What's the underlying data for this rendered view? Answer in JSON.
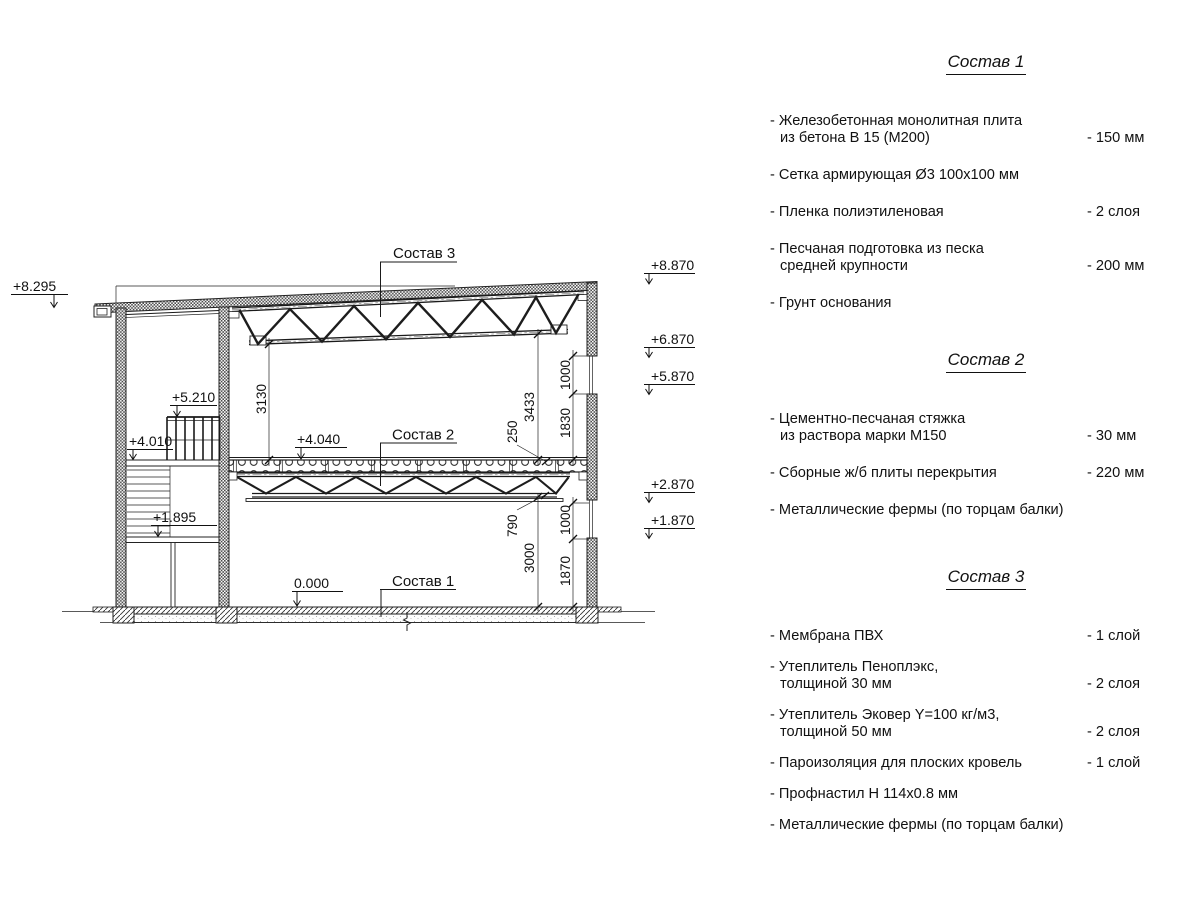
{
  "colors": {
    "line": "#1a1a1a",
    "background": "#ffffff"
  },
  "compositions": [
    {
      "title": "Состав 1",
      "items": [
        {
          "lines": [
            "- Железобетонная  монолитная плита",
            "из бетона В 15 (М200)"
          ],
          "value": "- 150 мм"
        },
        {
          "lines": [
            "- Сетка армирующая Ø3 100x100 мм"
          ],
          "value": ""
        },
        {
          "lines": [
            "- Пленка полиэтиленовая"
          ],
          "value": "-  2 слоя"
        },
        {
          "lines": [
            "- Песчаная подготовка из песка",
            "средней крупности"
          ],
          "value": "- 200 мм"
        },
        {
          "lines": [
            "- Грунт основания"
          ],
          "value": ""
        }
      ]
    },
    {
      "title": "Состав 2",
      "items": [
        {
          "lines": [
            "- Цементно-песчаная стяжка",
            "из раствора марки М150"
          ],
          "value": "- 30 мм"
        },
        {
          "lines": [
            "- Сборные ж/б плиты перекрытия"
          ],
          "value": "- 220 мм"
        },
        {
          "lines": [
            "- Металлические фермы (по торцам балки)"
          ],
          "value": ""
        }
      ]
    },
    {
      "title": "Состав 3",
      "items": [
        {
          "lines": [
            "- Мембрана ПВХ"
          ],
          "value": "- 1 слой"
        },
        {
          "lines": [
            "- Утеплитель Пеноплэкс,",
            "толщиной 30 мм"
          ],
          "value": "- 2 слоя"
        },
        {
          "lines": [
            "- Утеплитель Эковер Y=100 кг/м3,",
            "толщиной 50 мм"
          ],
          "value": "- 2 слоя"
        },
        {
          "lines": [
            "- Пароизоляция для плоских кровель"
          ],
          "value": "- 1 слой"
        },
        {
          "lines": [
            "- Профнастил Н 114x0.8 мм"
          ],
          "value": ""
        },
        {
          "lines": [
            "- Металлические фермы (по торцам балки)"
          ],
          "value": ""
        }
      ]
    }
  ],
  "drawing": {
    "callouts": {
      "c1": "Состав 1",
      "c2": "Состав 2",
      "c3": "Состав 3"
    },
    "elevations": {
      "e8295": "+8.295",
      "e5210": "+5.210",
      "e4010": "+4.010",
      "e1895": "+1.895",
      "e4040": "+4.040",
      "e0000": "0.000",
      "e8870": "+8.870",
      "e6870": "+6.870",
      "e5870": "+5.870",
      "e2870": "+2.870",
      "e1870": "+1.870"
    },
    "dimensions": {
      "d3130": "3130",
      "d3433": "3433",
      "d250": "250",
      "d1000_top": "1000",
      "d1830": "1830",
      "d790": "790",
      "d3000": "3000",
      "d1000_bottom": "1000",
      "d1870": "1870"
    }
  }
}
